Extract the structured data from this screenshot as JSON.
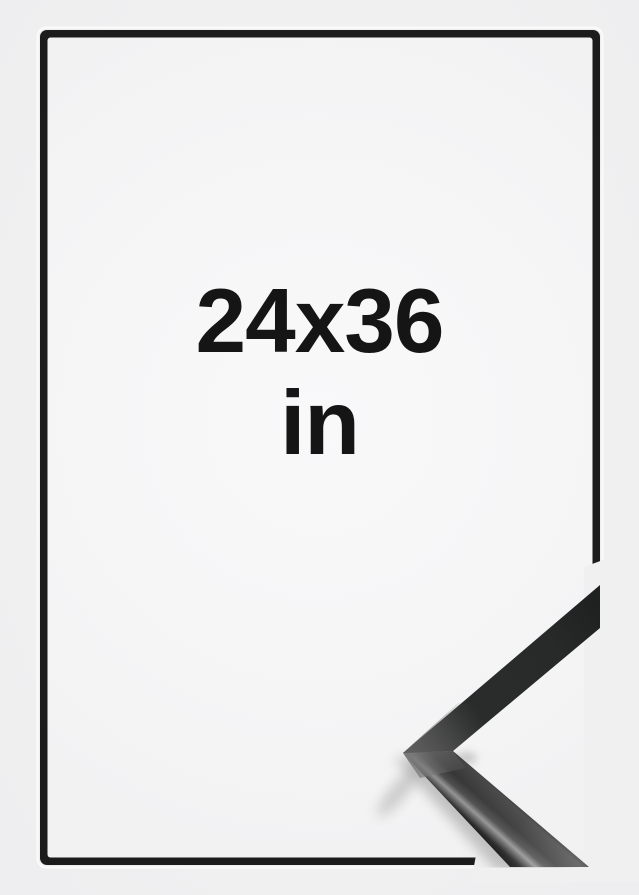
{
  "size_label": {
    "line1": "24x36",
    "line2": "in"
  },
  "colors": {
    "bg": "#f0f0f1",
    "frame": "#1c1c1c",
    "mat": "#f5f5f6",
    "label-text": "#151515"
  }
}
